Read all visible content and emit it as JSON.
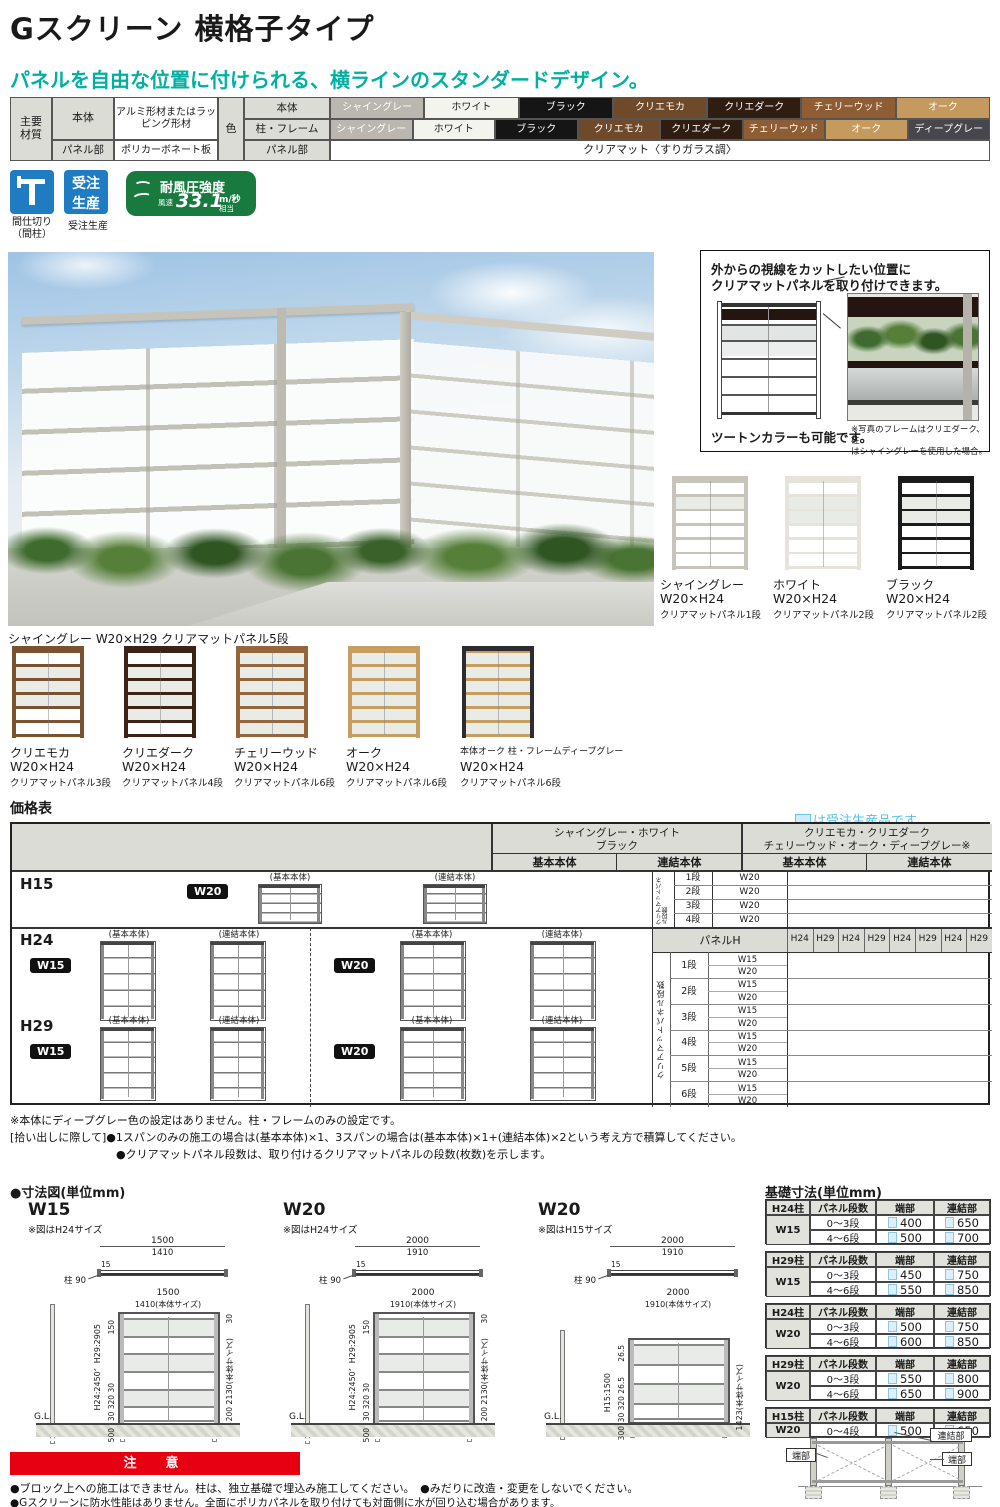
{
  "page": {
    "title": "Gスクリーン 横格子タイプ",
    "subtitle": "パネルを自由な位置に付けられる、横ラインのスタンダードデザイン。"
  },
  "materials": {
    "group_label_1": "主要",
    "group_label_2": "材質",
    "left_rows": [
      {
        "part": "本体",
        "material": "アルミ形材またはラッピング形材"
      },
      {
        "part": "パネル部",
        "material": "ポリカーボネート板"
      }
    ],
    "color_label": "色",
    "color_rows": [
      {
        "part": "本体",
        "swatches": [
          {
            "name": "シャイングレー",
            "bg": "#b9b7b0",
            "fg": "#ffffff"
          },
          {
            "name": "ホワイト",
            "bg": "#f4f4ef",
            "fg": "#222222"
          },
          {
            "name": "ブラック",
            "bg": "#151515",
            "fg": "#ffffff"
          },
          {
            "name": "クリエモカ",
            "bg": "#6f4a2a",
            "fg": "#ffffff"
          },
          {
            "name": "クリエダーク",
            "bg": "#301d12",
            "fg": "#ffffff"
          },
          {
            "name": "チェリーウッド",
            "bg": "#8e5d33",
            "fg": "#ffffff"
          },
          {
            "name": "オーク",
            "bg": "#c49a5f",
            "fg": "#ffffff"
          }
        ]
      },
      {
        "part": "柱・フレーム",
        "swatches": [
          {
            "name": "シャイングレー",
            "bg": "#b9b7b0",
            "fg": "#ffffff"
          },
          {
            "name": "ホワイト",
            "bg": "#f4f4ef",
            "fg": "#222222"
          },
          {
            "name": "ブラック",
            "bg": "#151515",
            "fg": "#ffffff"
          },
          {
            "name": "クリエモカ",
            "bg": "#6f4a2a",
            "fg": "#ffffff"
          },
          {
            "name": "クリエダーク",
            "bg": "#301d12",
            "fg": "#ffffff"
          },
          {
            "name": "チェリーウッド",
            "bg": "#8e5d33",
            "fg": "#ffffff"
          },
          {
            "name": "オーク",
            "bg": "#c49a5f",
            "fg": "#ffffff"
          },
          {
            "name": "ディープグレー",
            "bg": "#46464c",
            "fg": "#ffffff"
          }
        ]
      },
      {
        "part": "パネル部",
        "panel_text": "クリアマット〈すりガラス調〉"
      }
    ]
  },
  "badges": {
    "partition_caption_1": "間仕切り",
    "partition_caption_2": "（間柱）",
    "order_icon_line1": "受注",
    "order_icon_line2": "生産",
    "order_caption": "受注生産",
    "wind_title": "耐風圧強度",
    "wind_prefix": "風速",
    "wind_value": "33.1",
    "wind_unit_top": "m/秒",
    "wind_unit_bottom": "相当"
  },
  "hero": {
    "caption": "シャイングレー W20×H29 クリアマットパネル5段"
  },
  "feature": {
    "headline_1": "外からの視線をカットしたい位置に",
    "headline_2": "クリアマットパネルを取り付けできます。",
    "two_tone": "ツートンカラーも可能です。",
    "photo_note_1": "※写真のフレームはクリエダーク、柱",
    "photo_note_2": "はシャイングレーを使用した場合。"
  },
  "variants_right": [
    {
      "name": "シャイングレー",
      "size": "W20×H24",
      "panel": "クリアマットパネル1段",
      "frame": "#c6c4bb",
      "rail": "#c6c4bb",
      "panel_rows": [
        1
      ]
    },
    {
      "name": "ホワイト",
      "size": "W20×H24",
      "panel": "クリアマットパネル2段",
      "frame": "#e6e4da",
      "rail": "#e6e4da",
      "panel_rows": [
        1,
        2
      ]
    },
    {
      "name": "ブラック",
      "size": "W20×H24",
      "panel": "クリアマットパネル2段",
      "frame": "#1b1b1b",
      "rail": "#1b1b1b",
      "panel_rows": [
        1,
        2
      ]
    }
  ],
  "variants_bottom": [
    {
      "name": "クリエモカ",
      "size": "W20×H24",
      "panel": "クリアマットパネル3段",
      "frame": "#7a5230",
      "rail": "#7a5230",
      "panel_rows": [
        1,
        2,
        3
      ]
    },
    {
      "name": "クリエダーク",
      "size": "W20×H24",
      "panel": "クリアマットパネル4段",
      "frame": "#3c2315",
      "rail": "#3c2315",
      "panel_rows": [
        1,
        2,
        3,
        4
      ]
    },
    {
      "name": "チェリーウッド",
      "size": "W20×H24",
      "panel": "クリアマットパネル6段",
      "frame": "#97653a",
      "rail": "#97653a",
      "panel_rows": [
        0,
        1,
        2,
        3,
        4,
        5
      ]
    },
    {
      "name": "オーク",
      "size": "W20×H24",
      "panel": "クリアマットパネル6段",
      "frame": "#c79d60",
      "rail": "#c79d60",
      "panel_rows": [
        0,
        1,
        2,
        3,
        4,
        5
      ]
    },
    {
      "name": "本体オーク 柱・フレームディープグレー",
      "size": "W20×H24",
      "panel": "クリアマットパネル6段",
      "frame": "#2c2c31",
      "rail": "#c79d60",
      "panel_rows": [
        0,
        1,
        2,
        3,
        4,
        5
      ]
    }
  ],
  "price": {
    "title": "価格表",
    "order_note": "は受注生産品です。",
    "group1_line1": "シャイングレー・ホワイト",
    "group1_line2": "ブラック",
    "group2_line1": "クリエモカ・クリエダーク",
    "group2_line2": "チェリーウッド・オーク・ディープグレー※",
    "sub_basic": "基本本体",
    "sub_link": "連結本体",
    "panel_h_label": "パネルH",
    "panel_h_cols": [
      "H24",
      "H29",
      "H24",
      "H29",
      "H24",
      "H29",
      "H24",
      "H29"
    ],
    "h15_label": "H15",
    "h24_label": "H24",
    "h29_label": "H29",
    "w15_badge": "W15",
    "w20_badge": "W20",
    "basic_label": "(基本本体)",
    "link_label": "(連結本体)",
    "dan_vertical": "クリアマットパネル段数",
    "h15_dan_rows": [
      [
        "1段",
        "W20"
      ],
      [
        "2段",
        "W20"
      ],
      [
        "3段",
        "W20"
      ],
      [
        "4段",
        "W20"
      ]
    ],
    "dan_rows": [
      [
        "1段",
        "W15",
        "W20"
      ],
      [
        "2段",
        "W15",
        "W20"
      ],
      [
        "3段",
        "W15",
        "W20"
      ],
      [
        "4段",
        "W15",
        "W20"
      ],
      [
        "5段",
        "W15",
        "W20"
      ],
      [
        "6段",
        "W15",
        "W20"
      ]
    ]
  },
  "price_notes": [
    "※本体にディープグレー色の設定はありません。柱・フレームのみの設定です。",
    "[拾い出しに際して]●1スパンのみの施工の場合は(基本本体)×1、3スパンの場合は(基本本体)×1+(連結本体)×2という考え方で積算してください。",
    "●クリアマットパネル段数は、取り付けるクリアマットパネルの段数(枚数)を示します。"
  ],
  "dims": {
    "title": "●寸法図(単位mm)",
    "figures": [
      {
        "name": "W15",
        "note": "※図はH24サイズ",
        "top_w1": "1500",
        "top_w2": "1410",
        "top_t": "15",
        "post_label": "柱 90",
        "front_w1": "1500",
        "front_w2": "1410(本体サイズ)",
        "top_offset": "150",
        "top_right": "30",
        "height_label": "H24:2450、H29:2905",
        "body_height": "2130(本体サイズ)",
        "bottom_stack": "30 320 30",
        "bottom_right": "200",
        "embed": "500",
        "gl": "G.L.",
        "tall": true
      },
      {
        "name": "W20",
        "note": "※図はH24サイズ",
        "top_w1": "2000",
        "top_w2": "1910",
        "top_t": "15",
        "post_label": "柱 90",
        "front_w1": "2000",
        "front_w2": "1910(本体サイズ)",
        "top_offset": "150",
        "top_right": "30",
        "height_label": "H24:2450、H29:2905",
        "body_height": "2130(本体サイズ)",
        "bottom_stack": "30 320 30",
        "bottom_right": "200",
        "embed": "500",
        "gl": "G.L.",
        "tall": true
      },
      {
        "name": "W20",
        "note": "※図はH15サイズ",
        "top_w1": "2000",
        "top_w2": "1910",
        "top_t": "15",
        "post_label": "柱 90",
        "front_w1": "2000",
        "front_w2": "1910(本体サイズ)",
        "top_offset": "26.5",
        "top_right": "",
        "height_label": "H15:1500",
        "body_height": "1423(本体サイズ)",
        "bottom_stack": "30 320 26.5",
        "bottom_right": "",
        "embed": "300",
        "gl": "G.L.",
        "tall": false
      }
    ]
  },
  "foundation": {
    "title": "基礎寸法(単位mm)",
    "headers": {
      "dan": "パネル段数",
      "tan": "端部",
      "ren": "連結部"
    },
    "tables": [
      {
        "post": "H24柱",
        "w": "W15",
        "rows": [
          {
            "dan": "0〜3段",
            "tan": "400",
            "ren": "650"
          },
          {
            "dan": "4〜6段",
            "tan": "500",
            "ren": "700"
          }
        ]
      },
      {
        "post": "H29柱",
        "w": "W15",
        "rows": [
          {
            "dan": "0〜3段",
            "tan": "450",
            "ren": "750"
          },
          {
            "dan": "4〜6段",
            "tan": "550",
            "ren": "850"
          }
        ]
      },
      {
        "post": "H24柱",
        "w": "W20",
        "rows": [
          {
            "dan": "0〜3段",
            "tan": "500",
            "ren": "750"
          },
          {
            "dan": "4〜6段",
            "tan": "600",
            "ren": "850"
          }
        ]
      },
      {
        "post": "H29柱",
        "w": "W20",
        "rows": [
          {
            "dan": "0〜3段",
            "tan": "550",
            "ren": "800"
          },
          {
            "dan": "4〜6段",
            "tan": "650",
            "ren": "900"
          }
        ]
      },
      {
        "post": "H15柱",
        "w": "W20",
        "rows": [
          {
            "dan": "0〜4段",
            "tan": "500",
            "ren": "650"
          }
        ]
      }
    ],
    "diagram": {
      "left": "端部",
      "mid": "連結部",
      "right": "端部"
    }
  },
  "caution": {
    "banner": "注　意",
    "lines": [
      "●ブロック上への施工はできません。柱は、独立基礎で埋込み施工してください。　●みだりに改造・変更をしないでください。",
      "●Gスクリーンに防水性能はありません。全面にポリカパネルを取り付けても対面側に水が回り込む場合があります。"
    ]
  },
  "colors": {
    "accent_teal": "#00b1a3",
    "caution_red": "#e60012",
    "order_blue": "#54c0ec",
    "icon_blue": "#1f7bc2",
    "wind_green": "#187a3e"
  }
}
